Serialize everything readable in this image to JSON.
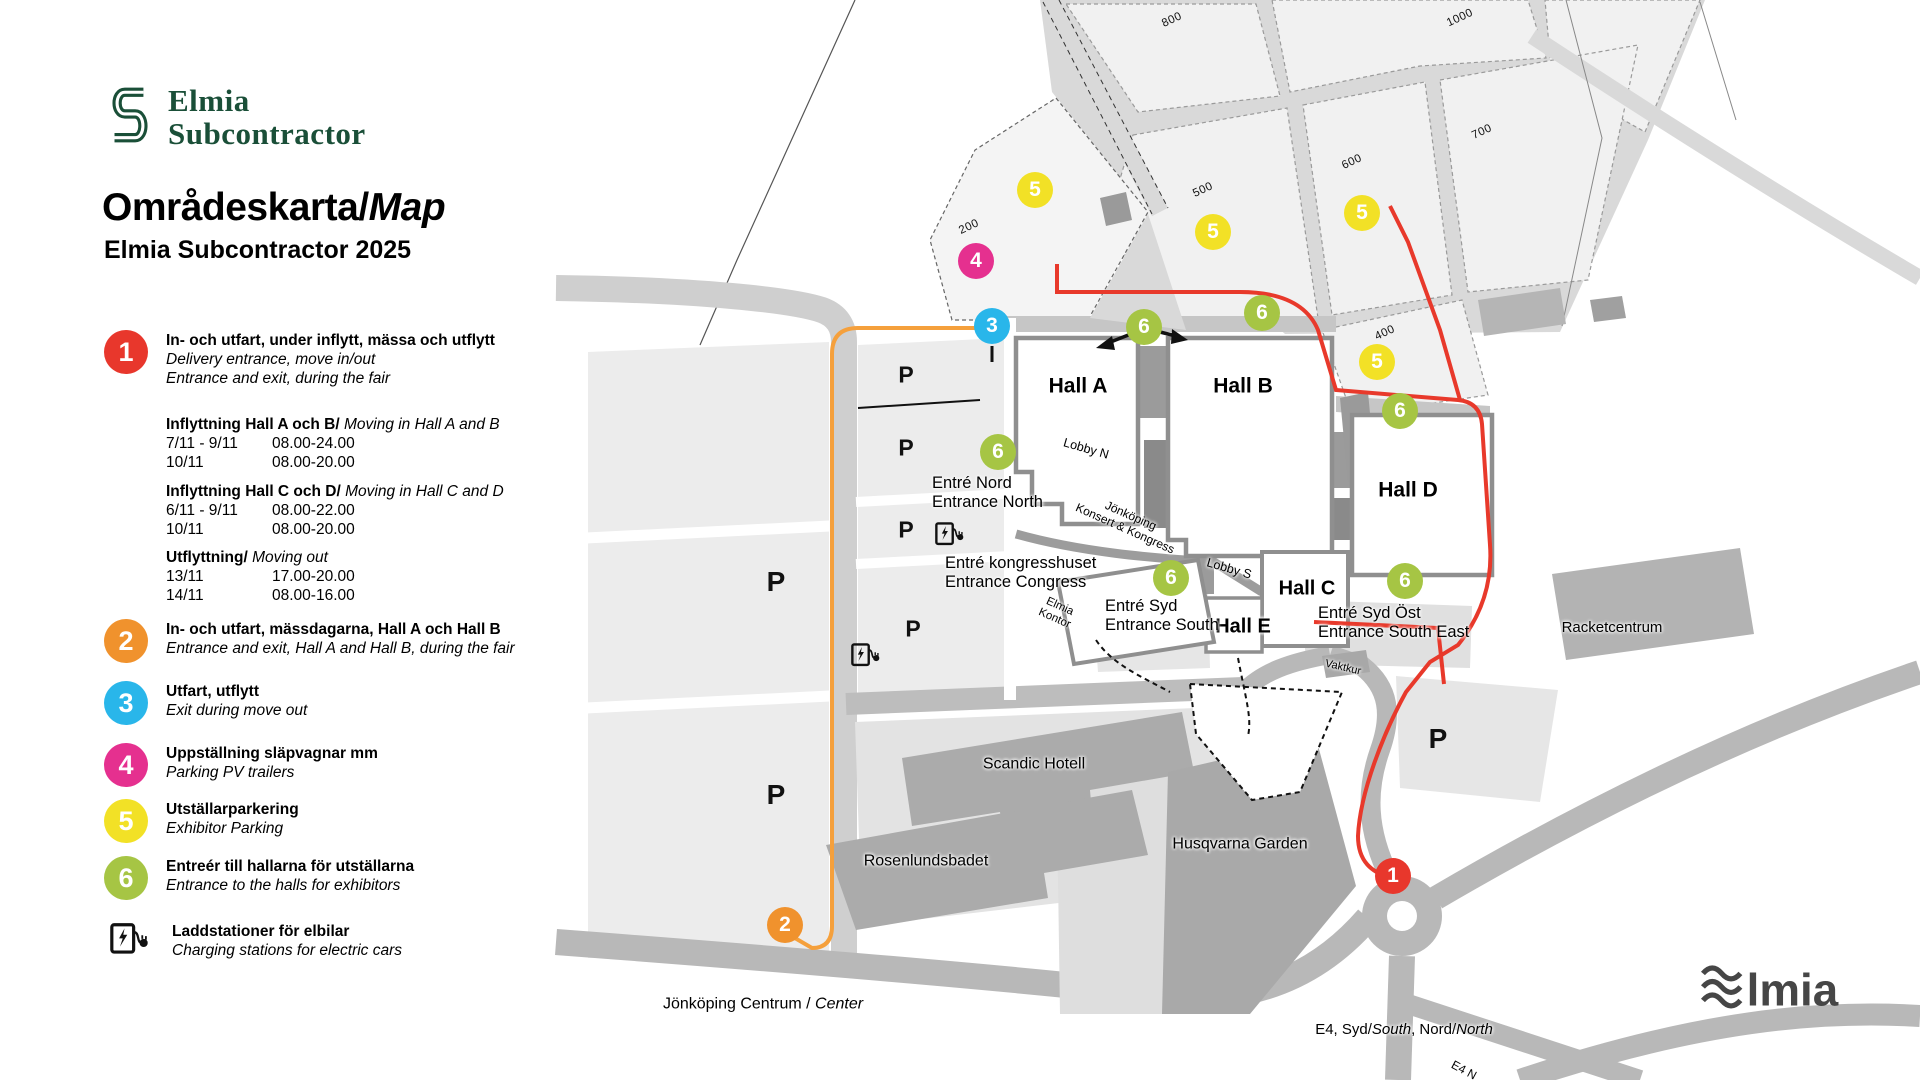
{
  "branding": {
    "logo_line1": "Elmia",
    "logo_line2": "Subcontractor",
    "title_main": "Områdeskarta/",
    "title_italic": "Map",
    "subtitle": "Elmia Subcontractor 2025",
    "footer_logo_text": "lmia"
  },
  "colors": {
    "red": "#e8372c",
    "orange": "#f0922d",
    "blue": "#29b6ea",
    "magenta": "#e5308f",
    "yellow": "#f2e126",
    "green": "#a6c544",
    "route_red": "#e8392b",
    "route_orange": "#f5a03c",
    "logo_green": "#1a4f38"
  },
  "legend": {
    "items": [
      {
        "type": "badge",
        "num": "1",
        "color": "#e8372c",
        "bold": "In- och utfart, under inflytt, mässa och utflytt",
        "italic": [
          "Delivery entrance, move in/out",
          "Entrance and exit, during the fair"
        ]
      },
      {
        "type": "schedule",
        "title_bold": "Inflyttning Hall A och B/",
        "title_italic": "Moving in Hall A and B",
        "rows": [
          [
            "7/11 - 9/11",
            "08.00-24.00"
          ],
          [
            "10/11",
            "08.00-20.00"
          ]
        ]
      },
      {
        "type": "schedule",
        "title_bold": "Inflyttning Hall C och D/",
        "title_italic": "Moving in Hall C and D",
        "rows": [
          [
            "6/11 - 9/11",
            "08.00-22.00"
          ],
          [
            "10/11",
            "08.00-20.00"
          ]
        ]
      },
      {
        "type": "schedule",
        "title_bold": "Utflyttning/",
        "title_italic": "Moving out",
        "rows": [
          [
            "13/11",
            "17.00-20.00"
          ],
          [
            "14/11",
            "08.00-16.00"
          ]
        ]
      },
      {
        "type": "badge",
        "num": "2",
        "color": "#f0922d",
        "bold": "In- och utfart, mässdagarna, Hall A och Hall B",
        "italic": [
          "Entrance and exit, Hall A and Hall B, during the fair"
        ]
      },
      {
        "type": "badge",
        "num": "3",
        "color": "#29b6ea",
        "bold": "Utfart, utflytt",
        "italic": [
          "Exit during move out"
        ]
      },
      {
        "type": "badge",
        "num": "4",
        "color": "#e5308f",
        "bold": "Uppställning släpvagnar mm",
        "italic": [
          "Parking PV trailers"
        ]
      },
      {
        "type": "badge",
        "num": "5",
        "color": "#f2e126",
        "bold": "Utställarparkering",
        "italic": [
          "Exhibitor Parking"
        ]
      },
      {
        "type": "badge",
        "num": "6",
        "color": "#a6c544",
        "bold": "Entreér till hallarna för utställarna",
        "italic": [
          "Entrance to the halls for exhibitors"
        ]
      },
      {
        "type": "charging",
        "bold": "Laddstationer för elbilar",
        "italic": [
          "Charging stations for electric cars"
        ]
      }
    ]
  },
  "map": {
    "badges": [
      {
        "num": "5",
        "color": "#f2e126",
        "x": 1035,
        "y": 190
      },
      {
        "num": "5",
        "color": "#f2e126",
        "x": 1213,
        "y": 232
      },
      {
        "num": "5",
        "color": "#f2e126",
        "x": 1362,
        "y": 213
      },
      {
        "num": "5",
        "color": "#f2e126",
        "x": 1377,
        "y": 362
      },
      {
        "num": "4",
        "color": "#e5308f",
        "x": 976,
        "y": 261
      },
      {
        "num": "3",
        "color": "#29b6ea",
        "x": 992,
        "y": 326
      },
      {
        "num": "6",
        "color": "#a6c544",
        "x": 1144,
        "y": 327
      },
      {
        "num": "6",
        "color": "#a6c544",
        "x": 1262,
        "y": 313
      },
      {
        "num": "6",
        "color": "#a6c544",
        "x": 998,
        "y": 452
      },
      {
        "num": "6",
        "color": "#a6c544",
        "x": 1400,
        "y": 411
      },
      {
        "num": "6",
        "color": "#a6c544",
        "x": 1171,
        "y": 578
      },
      {
        "num": "6",
        "color": "#a6c544",
        "x": 1405,
        "y": 581
      },
      {
        "num": "1",
        "color": "#e8372c",
        "x": 1393,
        "y": 876
      },
      {
        "num": "2",
        "color": "#f0922d",
        "x": 785,
        "y": 925
      }
    ],
    "p_markers": [
      {
        "x": 906,
        "y": 375,
        "s": 23
      },
      {
        "x": 906,
        "y": 448,
        "s": 23
      },
      {
        "x": 906,
        "y": 530,
        "s": 23
      },
      {
        "x": 776,
        "y": 582,
        "s": 28
      },
      {
        "x": 913,
        "y": 629,
        "s": 23
      },
      {
        "x": 776,
        "y": 795,
        "s": 28
      },
      {
        "x": 1438,
        "y": 739,
        "s": 28
      }
    ],
    "charging_stations": [
      {
        "x": 950,
        "y": 533
      },
      {
        "x": 866,
        "y": 654
      }
    ],
    "lot_labels": [
      {
        "text": "800",
        "x": 1172,
        "y": 20
      },
      {
        "text": "1000",
        "x": 1460,
        "y": 18
      },
      {
        "text": "500",
        "x": 1203,
        "y": 190
      },
      {
        "text": "600",
        "x": 1352,
        "y": 162
      },
      {
        "text": "700",
        "x": 1482,
        "y": 132
      },
      {
        "text": "200",
        "x": 969,
        "y": 227
      },
      {
        "text": "400",
        "x": 1385,
        "y": 333
      }
    ],
    "labels": [
      {
        "lines": [
          "Hall A"
        ],
        "x": 1078,
        "y": 386,
        "size": 21,
        "bold": true,
        "align": "center"
      },
      {
        "lines": [
          "Hall B"
        ],
        "x": 1243,
        "y": 386,
        "size": 21,
        "bold": true,
        "align": "center"
      },
      {
        "lines": [
          "Hall C"
        ],
        "x": 1307,
        "y": 589,
        "size": 20,
        "bold": true,
        "align": "center"
      },
      {
        "lines": [
          "Hall D"
        ],
        "x": 1408,
        "y": 490,
        "size": 21,
        "bold": true,
        "align": "center"
      },
      {
        "lines": [
          "Hall E"
        ],
        "x": 1243,
        "y": 627,
        "size": 20,
        "bold": true,
        "align": "center"
      },
      {
        "lines": [
          "Lobby N"
        ],
        "x": 1086,
        "y": 449,
        "size": 12.5,
        "rot": 16,
        "align": "center"
      },
      {
        "lines": [
          "Lobby S"
        ],
        "x": 1229,
        "y": 569,
        "size": 12.5,
        "rot": 16,
        "align": "center"
      },
      {
        "lines": [
          "Jönköping",
          "Konsert & Kongress"
        ],
        "x": 1128,
        "y": 522,
        "size": 12,
        "rot": 24,
        "align": "center"
      },
      {
        "lines": [
          "Elmia",
          "Kontor"
        ],
        "x": 1057,
        "y": 613,
        "size": 11.5,
        "rot": 24,
        "align": "center"
      },
      {
        "lines": [
          "Vaktkur"
        ],
        "x": 1343,
        "y": 668,
        "size": 11,
        "rot": 13,
        "align": "center"
      },
      {
        "lines": [
          "Entré Nord",
          "Entrance North"
        ],
        "x": 932,
        "y": 493,
        "size": 16.5,
        "align": "left"
      },
      {
        "lines": [
          "Entré kongresshuset",
          "Entrance Congress"
        ],
        "x": 945,
        "y": 573,
        "size": 16.5,
        "align": "left"
      },
      {
        "lines": [
          "Entré Syd",
          "Entrance South"
        ],
        "x": 1105,
        "y": 616,
        "size": 16.5,
        "align": "left"
      },
      {
        "lines": [
          "Entré Syd Öst",
          "Entrance South East"
        ],
        "x": 1318,
        "y": 623,
        "size": 16.5,
        "align": "left"
      },
      {
        "lines": [
          "Scandic Hotell"
        ],
        "x": 1034,
        "y": 764,
        "size": 16,
        "align": "center"
      },
      {
        "lines": [
          "Husqvarna Garden"
        ],
        "x": 1240,
        "y": 844,
        "size": 16,
        "align": "center"
      },
      {
        "lines": [
          "Rosenlundsbadet"
        ],
        "x": 926,
        "y": 861,
        "size": 16,
        "align": "center"
      },
      {
        "lines": [
          "Racketcentrum"
        ],
        "x": 1612,
        "y": 628,
        "size": 15,
        "align": "center"
      },
      {
        "parts": [
          {
            "t": "Jönköping Centrum / "
          },
          {
            "t": "Center",
            "i": true
          }
        ],
        "x": 763,
        "y": 1004,
        "size": 16,
        "align": "center"
      },
      {
        "parts": [
          {
            "t": "E4, Syd/"
          },
          {
            "t": "South",
            "i": true
          },
          {
            "t": ", Nord/"
          },
          {
            "t": "North",
            "i": true
          }
        ],
        "x": 1404,
        "y": 1030,
        "size": 15,
        "align": "center"
      },
      {
        "parts": [
          {
            "t": "E4 N"
          }
        ],
        "x": 1464,
        "y": 1070,
        "size": 12,
        "rot": 28,
        "align": "center"
      }
    ]
  }
}
